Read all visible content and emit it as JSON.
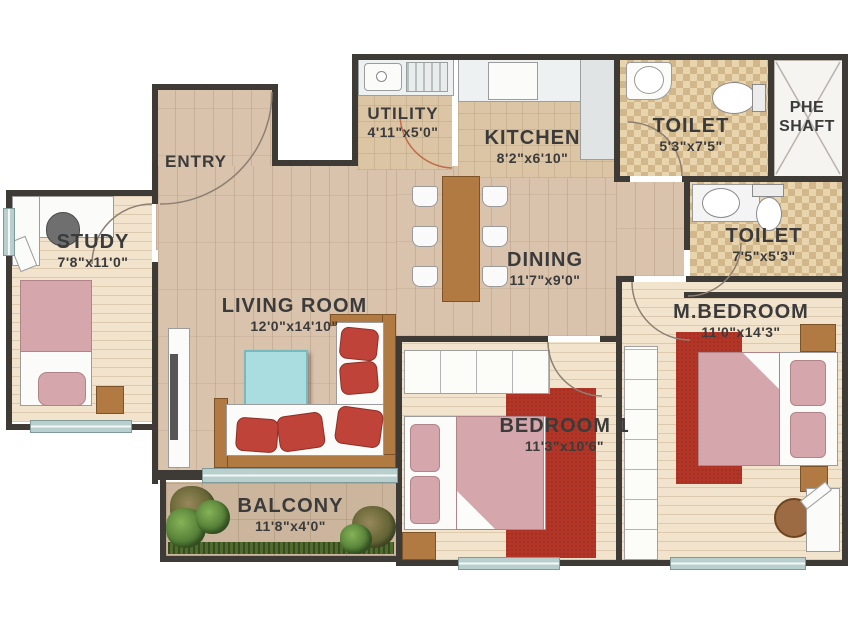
{
  "rooms": {
    "entry": {
      "label": "ENTRY"
    },
    "utility": {
      "label": "UTILITY",
      "size": "4'11\"x5'0\""
    },
    "kitchen": {
      "label": "KITCHEN",
      "size": "8'2\"x6'10\""
    },
    "toilet1": {
      "label": "TOILET",
      "size": "5'3\"x7'5\""
    },
    "phe": {
      "line1": "PHE",
      "line2": "SHAFT"
    },
    "toilet2": {
      "label": "TOILET",
      "size": "7'5\"x5'3\""
    },
    "study": {
      "label": "STUDY",
      "size": "7'8\"x11'0\""
    },
    "dining": {
      "label": "DINING",
      "size": "11'7\"x9'0\""
    },
    "living": {
      "label": "LIVING ROOM",
      "size": "12'0\"x14'10\""
    },
    "master_bedroom": {
      "label": "M.BEDROOM",
      "size": "11'0\"x14'3\""
    },
    "bedroom1": {
      "label": "BEDROOM 1",
      "size": "11'3\"x10'6\""
    },
    "balcony": {
      "label": "BALCONY",
      "size": "11'8\"x4'0\""
    }
  },
  "colors": {
    "wall": "#3e3a36",
    "floor-tan": "#d9c3ad",
    "floor-cream": "#f1e3cc",
    "floor-tile": "#dbc5a4",
    "floor-balcony": "#cbb69d",
    "rug-red": "#b23527",
    "cushion-red": "#bf4338",
    "blanket-pink": "#d5a6ab",
    "wood-brown": "#b17a42",
    "table-cyan": "#a9dde0",
    "window-teal": "#b8cfcd",
    "label-ink": "#3b3b3b"
  }
}
